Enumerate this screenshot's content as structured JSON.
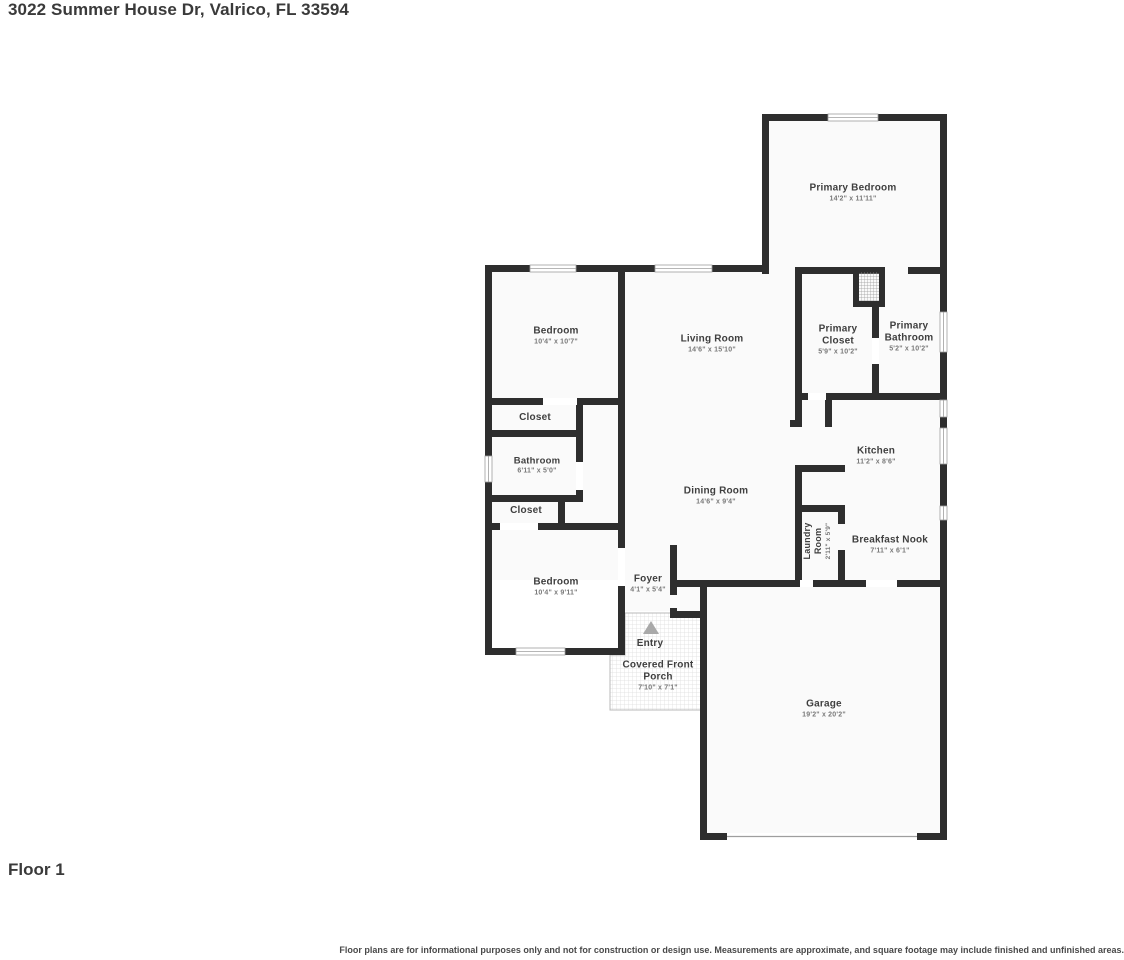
{
  "title": "3022 Summer House Dr, Valrico, FL 33594",
  "floor_label": "Floor 1",
  "disclaimer": "Floor plans are for informational purposes only and not for construction or design use. Measurements are approximate, and square footage may include finished and unfinished areas.",
  "colors": {
    "wall": "#2e2e2e",
    "floor": "#fafafa",
    "window_frame": "#9e9e9e",
    "entry_arrow": "#a9a9a9"
  },
  "rooms": {
    "primary_bedroom": {
      "name": "Primary Bedroom",
      "dims": "14'2\" x 11'11\""
    },
    "bedroom_top": {
      "name": "Bedroom",
      "dims": "10'4\" x 10'7\""
    },
    "living_room": {
      "name": "Living Room",
      "dims": "14'6\" x 15'10\""
    },
    "primary_closet": {
      "name": "Primary Closet",
      "dims": "5'9\" x 10'2\""
    },
    "primary_bathroom": {
      "name": "Primary Bathroom",
      "dims": "5'2\" x 10'2\""
    },
    "closet_upper": {
      "name": "Closet"
    },
    "bathroom": {
      "name": "Bathroom",
      "dims": "6'11\" x 5'0\""
    },
    "closet_lower": {
      "name": "Closet"
    },
    "kitchen": {
      "name": "Kitchen",
      "dims": "11'2\" x 8'6\""
    },
    "dining_room": {
      "name": "Dining Room",
      "dims": "14'6\" x 9'4\""
    },
    "laundry_room": {
      "name": "Laundry Room",
      "dims": "2'11\" x 5'9\""
    },
    "breakfast_nook": {
      "name": "Breakfast Nook",
      "dims": "7'11\" x 6'1\""
    },
    "bedroom_bottom": {
      "name": "Bedroom",
      "dims": "10'4\" x 9'11\""
    },
    "foyer": {
      "name": "Foyer",
      "dims": "4'1\" x 5'4\""
    },
    "entry": {
      "name": "Entry"
    },
    "covered_front_porch": {
      "name": "Covered Front Porch",
      "dims": "7'10\" x 7'1\""
    },
    "garage": {
      "name": "Garage",
      "dims": "19'2\" x 20'2\""
    }
  }
}
